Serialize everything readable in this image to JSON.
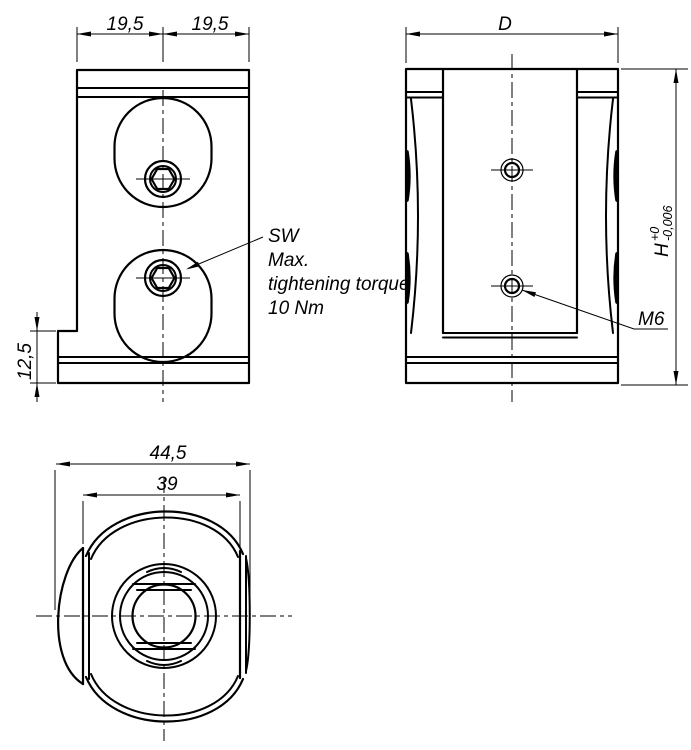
{
  "colors": {
    "line": "#000000",
    "background": "#ffffff"
  },
  "front_view": {
    "dim_top_left": "19,5",
    "dim_top_right": "19,5",
    "dim_step_height": "12,5",
    "note_lines": [
      "SW",
      "Max.",
      "tightening torque",
      "10 Nm"
    ]
  },
  "side_view": {
    "dim_width": "D",
    "dim_height_letter": "H",
    "dim_height_tol_upper": "+0",
    "dim_height_tol_lower": "-0,006",
    "thread_label": "M6"
  },
  "bottom_view": {
    "dim_outer_diameter": "44,5",
    "dim_across_flats": "39"
  }
}
